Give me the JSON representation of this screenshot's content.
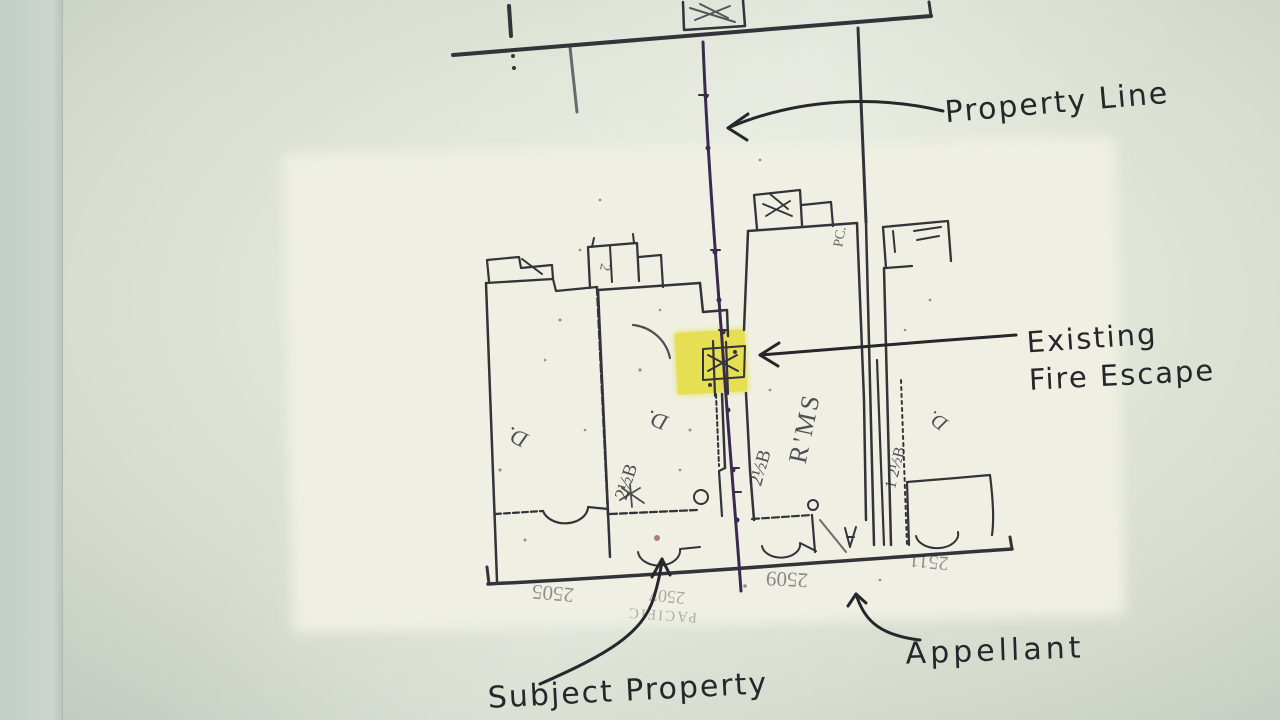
{
  "annotations": {
    "property_line": "Property Line",
    "existing_fire_escape_line1": "Existing",
    "existing_fire_escape_line2": "Fire Escape",
    "appellant": "Appellant",
    "subject_property": "Subject Property"
  },
  "map_labels": {
    "building_left_use": "D.",
    "building_mid_porch_number": "2",
    "building_mid_use": "D.",
    "building_mid_stories": "2½B",
    "building_right_rooms": "R'MS",
    "building_right_stories": "2½B",
    "building_right_pc": "PC.",
    "building_far_right_stories": "1 2½B",
    "building_far_right_use": "D.",
    "address_2505": "2505",
    "address_2507": "2507",
    "street_name": "PACIFIC",
    "address_2509": "2509",
    "address_2511": "2511"
  },
  "colors": {
    "map_ink": "#33333a",
    "property_line_ink": "#3b2a50",
    "handwriting_ink": "#26262b",
    "highlight_yellow": "#f4e93a",
    "map_paper": "#eff0e3",
    "paper": "#e2e6d9",
    "backdrop": "#c2cec8"
  }
}
